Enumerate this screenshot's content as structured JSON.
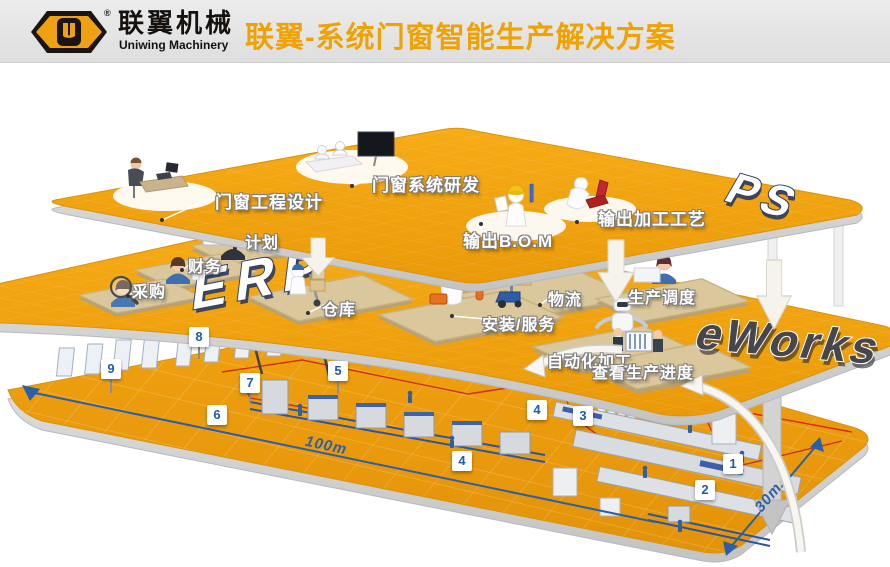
{
  "header": {
    "brand": "联翼机械",
    "brand_en": "Uniwing Machinery",
    "registered": "®",
    "title": "联翼-系统门窗智能生产解决方案"
  },
  "layers": {
    "ps": {
      "tag": "PS",
      "stations": [
        {
          "label": "门窗工程设计"
        },
        {
          "label": "门窗系统研发"
        },
        {
          "label": "输出B.O.M"
        },
        {
          "label": "输出加工工艺"
        }
      ]
    },
    "erp": {
      "tag": "ERP",
      "stations": [
        {
          "label": "计划"
        },
        {
          "label": "财务"
        },
        {
          "label": "采购"
        },
        {
          "label": "仓库"
        },
        {
          "label": "物流"
        },
        {
          "label": "安装/服务"
        }
      ]
    },
    "eworks": {
      "tag": "eWorks",
      "stations": [
        {
          "label": "生产调度"
        },
        {
          "label": "自动化加工"
        },
        {
          "label": "查看生产进度"
        }
      ]
    }
  },
  "floor": {
    "markers": [
      "1",
      "2",
      "3",
      "4",
      "4",
      "5",
      "6",
      "7",
      "8",
      "9"
    ],
    "dimensions": {
      "length": "100m",
      "width": "30m"
    }
  },
  "colors": {
    "platform_orange": "#F2A20F",
    "title_orange": "#F0A202",
    "marker_blue": "#1F5CA5",
    "dimension_blue": "#2B5FA8",
    "route_red": "#CE2218"
  }
}
